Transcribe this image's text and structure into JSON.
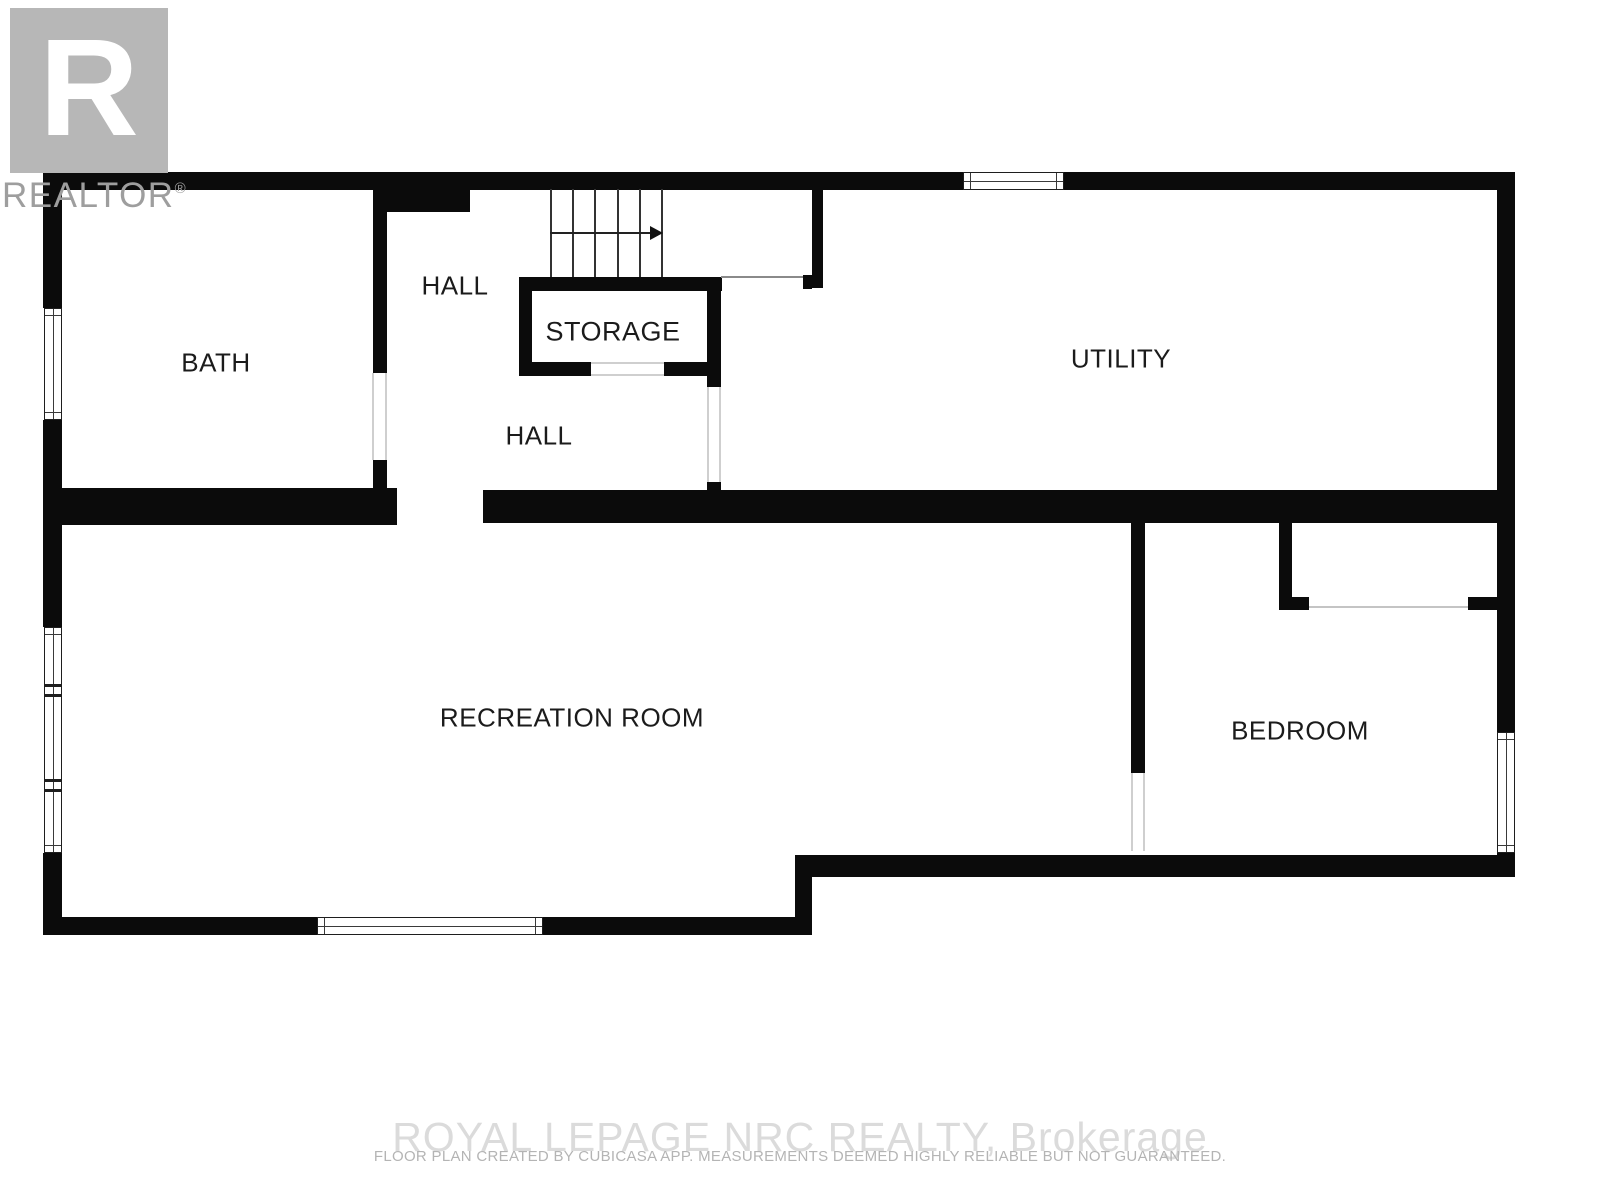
{
  "page": {
    "width": 1600,
    "height": 1200,
    "background": "#ffffff"
  },
  "logo": {
    "letter": "R",
    "wordmark": "REALTOR",
    "registered_symbol": "®",
    "box_color": "#b7b7b7",
    "wordmark_color": "#9e9e9e"
  },
  "rooms": [
    {
      "id": "bath",
      "label": "BATH",
      "cx": 216,
      "cy": 363,
      "font_size": 26
    },
    {
      "id": "hall-upper",
      "label": "HALL",
      "cx": 455,
      "cy": 286,
      "font_size": 26
    },
    {
      "id": "storage",
      "label": "STORAGE",
      "cx": 613,
      "cy": 332,
      "font_size": 27
    },
    {
      "id": "utility",
      "label": "UTILITY",
      "cx": 1121,
      "cy": 359,
      "font_size": 26
    },
    {
      "id": "hall-lower",
      "label": "HALL",
      "cx": 539,
      "cy": 436,
      "font_size": 26
    },
    {
      "id": "recreation-room",
      "label": "RECREATION ROOM",
      "cx": 572,
      "cy": 718,
      "font_size": 26
    },
    {
      "id": "bedroom",
      "label": "BEDROOM",
      "cx": 1300,
      "cy": 731,
      "font_size": 26
    }
  ],
  "footer": {
    "brokerage": "ROYAL LEPAGE NRC REALTY, Brokerage",
    "disclaimer": "FLOOR PLAN CREATED BY CUBICASA APP. MEASUREMENTS DEEMED HIGHLY RELIABLE BUT NOT GUARANTEED."
  },
  "colors": {
    "wall": "#0b0b0b",
    "label": "#1b1b1b",
    "logo_gray": "#b7b7b7",
    "wordmark_gray": "#9e9e9e",
    "watermark_gray": "#dbdbdb",
    "disclaimer_gray": "#b4b4b4",
    "window_frame": "#1e1e1e",
    "door_jamb": "#cfcfcf"
  },
  "floorplan": {
    "walls": [
      {
        "name": "outer-top-wall",
        "x": 43,
        "y": 172,
        "w": 1472,
        "h": 18
      },
      {
        "name": "outer-left-wall-upper",
        "x": 43,
        "y": 172,
        "w": 19,
        "h": 136
      },
      {
        "name": "outer-left-wall-middle",
        "x": 43,
        "y": 420,
        "w": 19,
        "h": 207
      },
      {
        "name": "outer-left-wall-lower",
        "x": 43,
        "y": 853,
        "w": 19,
        "h": 82
      },
      {
        "name": "outer-bottom-wall-left",
        "x": 43,
        "y": 917,
        "w": 274,
        "h": 18
      },
      {
        "name": "outer-bottom-wall-right",
        "x": 543,
        "y": 917,
        "w": 269,
        "h": 18
      },
      {
        "name": "bottom-step-wall",
        "x": 795,
        "y": 855,
        "w": 17,
        "h": 80
      },
      {
        "name": "bedroom-bottom-wall",
        "x": 795,
        "y": 855,
        "w": 720,
        "h": 22
      },
      {
        "name": "outer-right-wall-upper",
        "x": 1497,
        "y": 172,
        "w": 18,
        "h": 560
      },
      {
        "name": "outer-right-wall-lower",
        "x": 1497,
        "y": 853,
        "w": 18,
        "h": 24
      },
      {
        "name": "hall-top-notch",
        "x": 375,
        "y": 188,
        "w": 95,
        "h": 24
      },
      {
        "name": "bath-right-wall-upper",
        "x": 373,
        "y": 190,
        "w": 14,
        "h": 183
      },
      {
        "name": "bath-right-wall-lower",
        "x": 373,
        "y": 460,
        "w": 14,
        "h": 30
      },
      {
        "name": "bath-bottom-wall",
        "x": 43,
        "y": 488,
        "w": 354,
        "h": 37
      },
      {
        "name": "middle-wall",
        "x": 483,
        "y": 490,
        "w": 1032,
        "h": 33
      },
      {
        "name": "storage-top-wall",
        "x": 519,
        "y": 277,
        "w": 203,
        "h": 14
      },
      {
        "name": "storage-left-wall",
        "x": 519,
        "y": 277,
        "w": 13,
        "h": 99
      },
      {
        "name": "storage-bottom-wall-left",
        "x": 519,
        "y": 362,
        "w": 72,
        "h": 14
      },
      {
        "name": "storage-bottom-wall-right",
        "x": 664,
        "y": 362,
        "w": 44,
        "h": 14
      },
      {
        "name": "storage-right-wall",
        "x": 707,
        "y": 277,
        "w": 14,
        "h": 110
      },
      {
        "name": "storage-right-wall-stub",
        "x": 707,
        "y": 482,
        "w": 14,
        "h": 12
      },
      {
        "name": "stair-landing-stub",
        "x": 803,
        "y": 275,
        "w": 9,
        "h": 14
      },
      {
        "name": "utility-left-wall",
        "x": 812,
        "y": 188,
        "w": 11,
        "h": 100
      },
      {
        "name": "bedroom-left-wall",
        "x": 1131,
        "y": 522,
        "w": 14,
        "h": 251
      },
      {
        "name": "bedroom-entry-left-stub",
        "x": 1279,
        "y": 522,
        "w": 13,
        "h": 88
      },
      {
        "name": "bedroom-entry-left-foot",
        "x": 1279,
        "y": 597,
        "w": 30,
        "h": 13
      },
      {
        "name": "bedroom-entry-right-flange",
        "x": 1468,
        "y": 597,
        "w": 29,
        "h": 13
      }
    ],
    "windows": [
      {
        "name": "utility-top-window",
        "orient": "h",
        "x": 963,
        "y": 172,
        "w": 101,
        "h": 18
      },
      {
        "name": "bath-window",
        "orient": "v",
        "x": 44,
        "y": 308,
        "w": 18,
        "h": 112
      },
      {
        "name": "recreation-left-window",
        "orient": "v",
        "x": 44,
        "y": 627,
        "w": 18,
        "h": 226,
        "dividers": [
          56,
          151
        ]
      },
      {
        "name": "recreation-bottom-window",
        "orient": "h",
        "x": 317,
        "y": 917,
        "w": 226,
        "h": 18
      },
      {
        "name": "bedroom-window",
        "orient": "v",
        "x": 1497,
        "y": 732,
        "w": 18,
        "h": 121
      }
    ],
    "openings": [
      {
        "name": "bath-door-jamb-left",
        "x": 372,
        "y": 373,
        "w": 2,
        "h": 87,
        "c": "#cfcfcf"
      },
      {
        "name": "bath-door-jamb-right",
        "x": 385,
        "y": 373,
        "w": 2,
        "h": 87,
        "c": "#cfcfcf"
      },
      {
        "name": "storage-door-line-top",
        "x": 591,
        "y": 362,
        "w": 73,
        "h": 2,
        "c": "#cfcfcf"
      },
      {
        "name": "storage-door-line-bottom",
        "x": 591,
        "y": 374,
        "w": 73,
        "h": 2,
        "c": "#cfcfcf"
      },
      {
        "name": "hall-door-jamb-left",
        "x": 707,
        "y": 387,
        "w": 2,
        "h": 95,
        "c": "#cfcfcf"
      },
      {
        "name": "hall-door-jamb-right",
        "x": 719,
        "y": 387,
        "w": 2,
        "h": 95,
        "c": "#cfcfcf"
      },
      {
        "name": "stair-landing-line",
        "x": 721,
        "y": 276,
        "w": 82,
        "h": 2,
        "c": "#8a8a8a"
      },
      {
        "name": "bedroom-entry-line",
        "x": 1309,
        "y": 606,
        "w": 159,
        "h": 2,
        "c": "#c4c4c4"
      },
      {
        "name": "bedroom-door-jamb-left",
        "x": 1131,
        "y": 773,
        "w": 2,
        "h": 78,
        "c": "#cfcfcf"
      },
      {
        "name": "bedroom-door-jamb-right",
        "x": 1143,
        "y": 773,
        "w": 2,
        "h": 78,
        "c": "#cfcfcf"
      }
    ],
    "stairs": {
      "x": 550,
      "y": 189,
      "w": 113,
      "h": 88,
      "tread_lines": 6,
      "arrow_y": 233,
      "direction": "right"
    }
  }
}
